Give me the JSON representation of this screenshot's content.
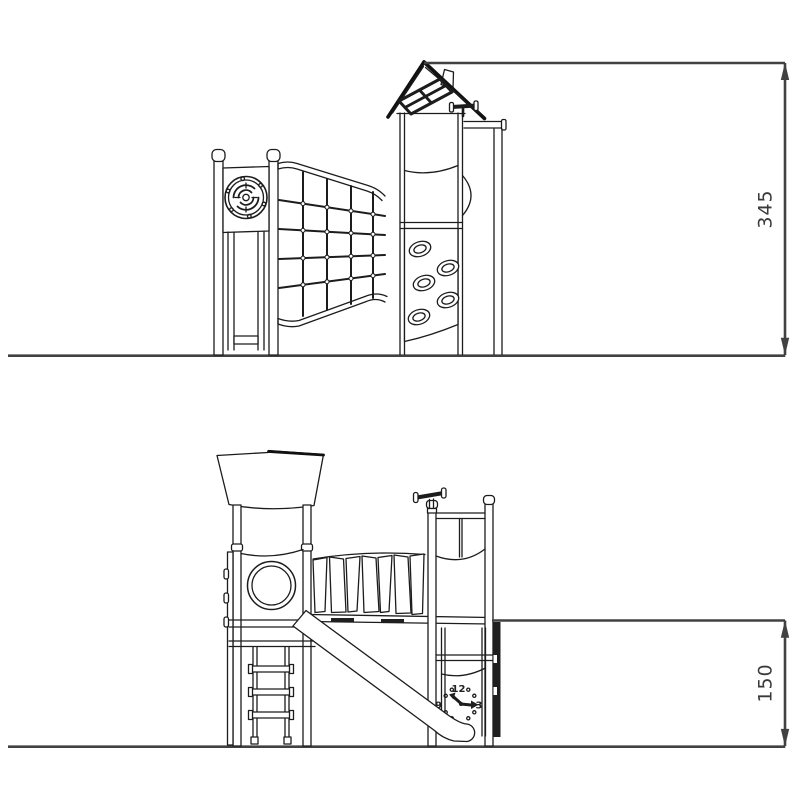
{
  "colors": {
    "background": "#ffffff",
    "line": "#1c1c1c",
    "dimension_line": "#414141",
    "dimension_text": "#3a3a3a",
    "dark_fill": "#1f1f1f"
  },
  "dimensions": {
    "top_height": "345",
    "bottom_height": "150"
  },
  "clock": {
    "twelve": "12",
    "three": "3",
    "nine": "9"
  }
}
